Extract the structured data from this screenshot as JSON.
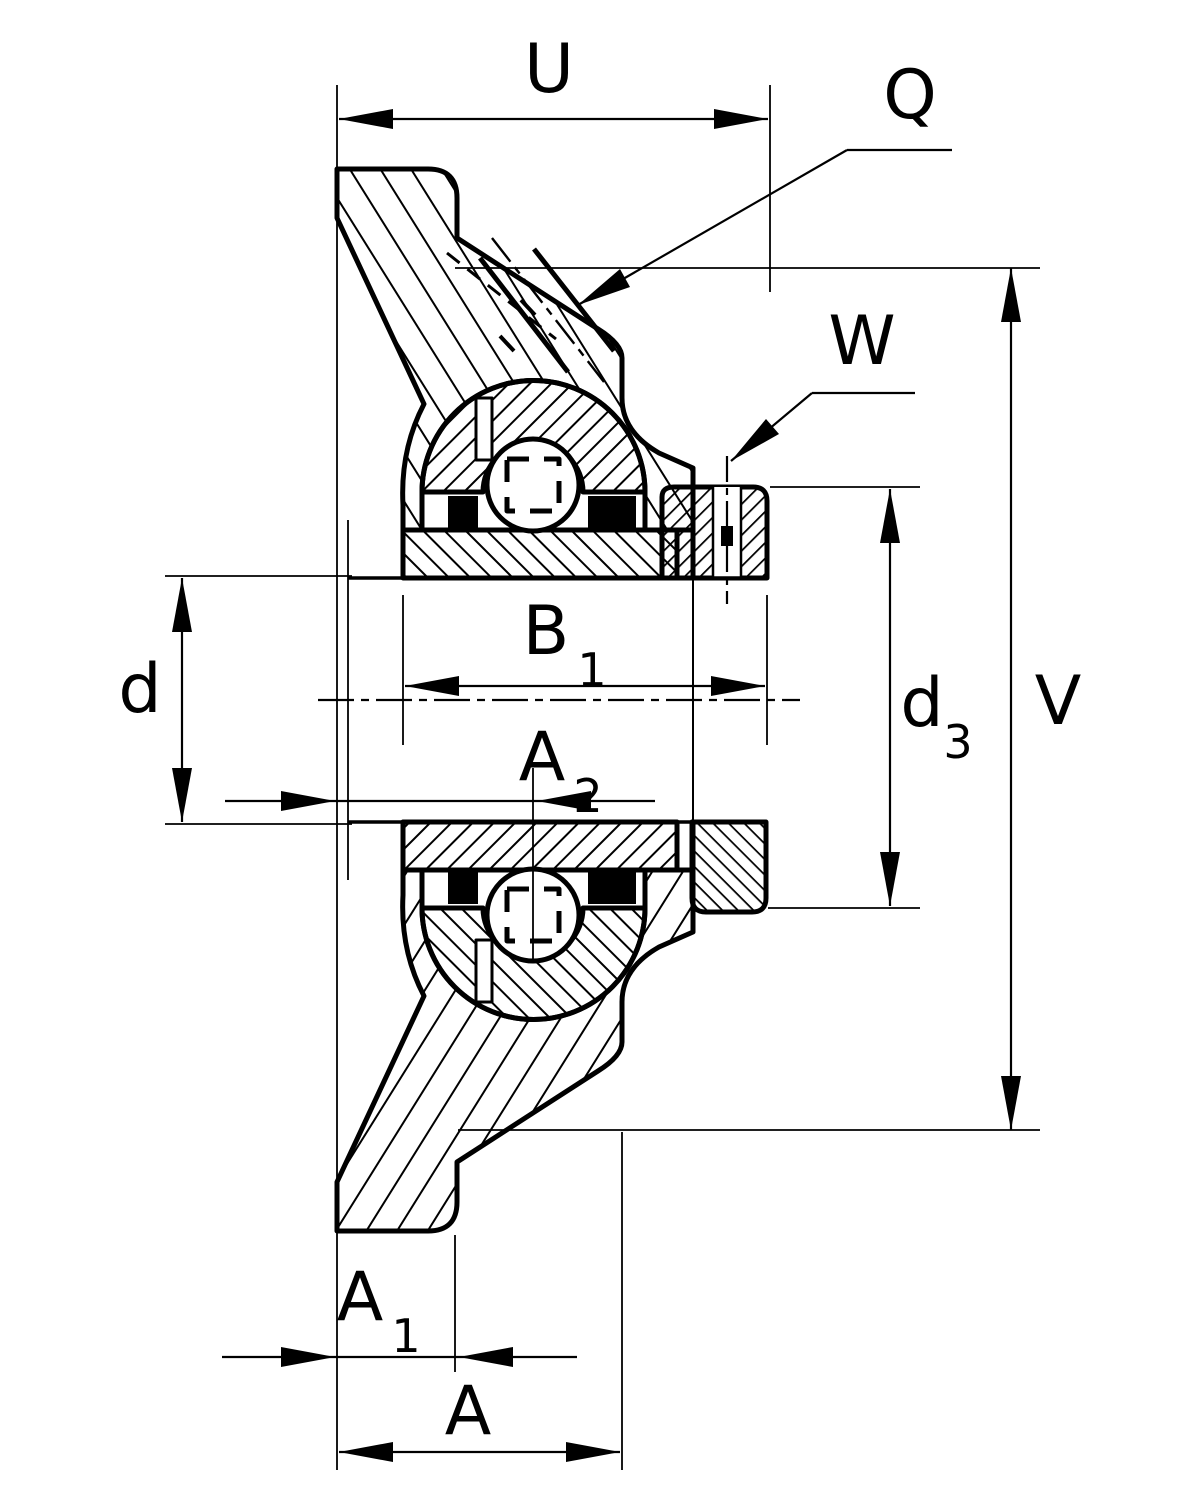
{
  "colors": {
    "line": "#000000",
    "background": "#ffffff"
  },
  "labels": {
    "u": "U",
    "q": "Q",
    "w": "W",
    "d": "d",
    "b1": {
      "base": "B",
      "sub": "1"
    },
    "a2": {
      "base": "A",
      "sub": "2"
    },
    "d3": {
      "base": "d",
      "sub": "3"
    },
    "v": "V",
    "a1": {
      "base": "A",
      "sub": "1"
    },
    "a": "A"
  }
}
